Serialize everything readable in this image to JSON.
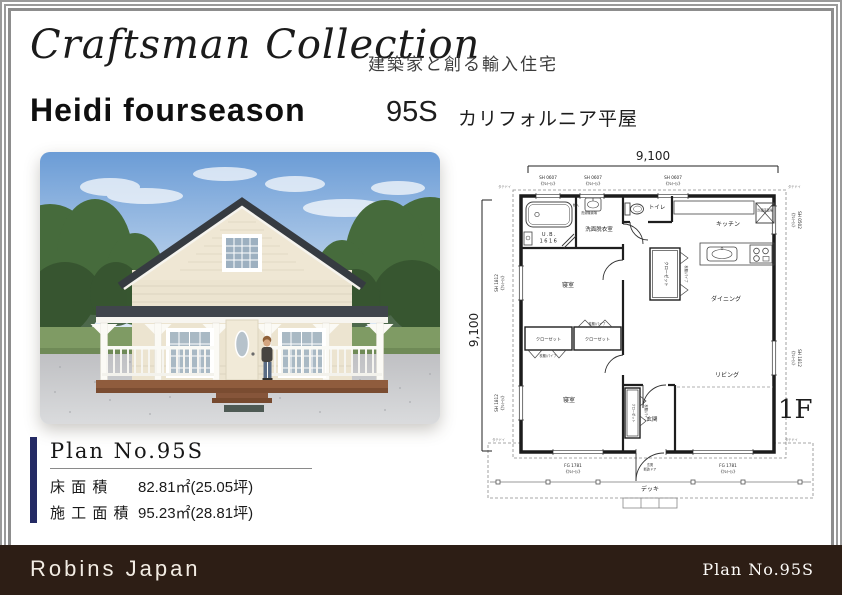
{
  "header": {
    "brand_script": "Craftsman Collection",
    "brand_tagline": "建築家と創る輸入住宅",
    "model_name": "Heidi fourseason",
    "model_code": "95S",
    "model_subtitle": "カリフォルニア平屋"
  },
  "floor_plan": {
    "dim_top": "9,100",
    "dim_left": "9,100",
    "floor_label": "1F",
    "glass_note": "《ｸﾚﾄｲｼ》",
    "win_top": [
      "SH 0607",
      "SH 0607",
      "SH 0607"
    ],
    "win_left": [
      "SH 1812",
      "SH 1812"
    ],
    "win_right": [
      "SH 0502",
      "SH 1812"
    ],
    "win_bottom": [
      "FG 1781",
      "FG 1781"
    ],
    "rooms": {
      "ub": "U.B.",
      "ub_size": "1616",
      "washroom": "洗面脱衣室",
      "toilet": "トイレ",
      "kitchen": "キッチン",
      "dining": "ダイニング",
      "living": "リビング",
      "bedroom": "寝室",
      "closet": "クローゼット",
      "entrance": "玄関",
      "deck": "デッキ",
      "storage": "物入",
      "laundry": "洗濯機置場",
      "fridge": "冷蔵庫置場"
    },
    "notes": {
      "shelf": "枕棚/パイプ",
      "downspout": "タテドイ",
      "entry_door_1": "玄関",
      "entry_door_2": "断熱ドア"
    }
  },
  "plan_info": {
    "title": "Plan No.95S",
    "rows": [
      {
        "label": "床 面 積",
        "value": "82.81㎡(25.05坪)"
      },
      {
        "label": "施 工 面 積",
        "value": "95.23㎡(28.81坪)"
      }
    ]
  },
  "footer": {
    "company": "Robins Japan",
    "plan_no": "Plan No.95S"
  },
  "colors": {
    "accent_bar": "#242a64",
    "footer_bg": "#2d1e15",
    "frame_line": "#999999"
  }
}
